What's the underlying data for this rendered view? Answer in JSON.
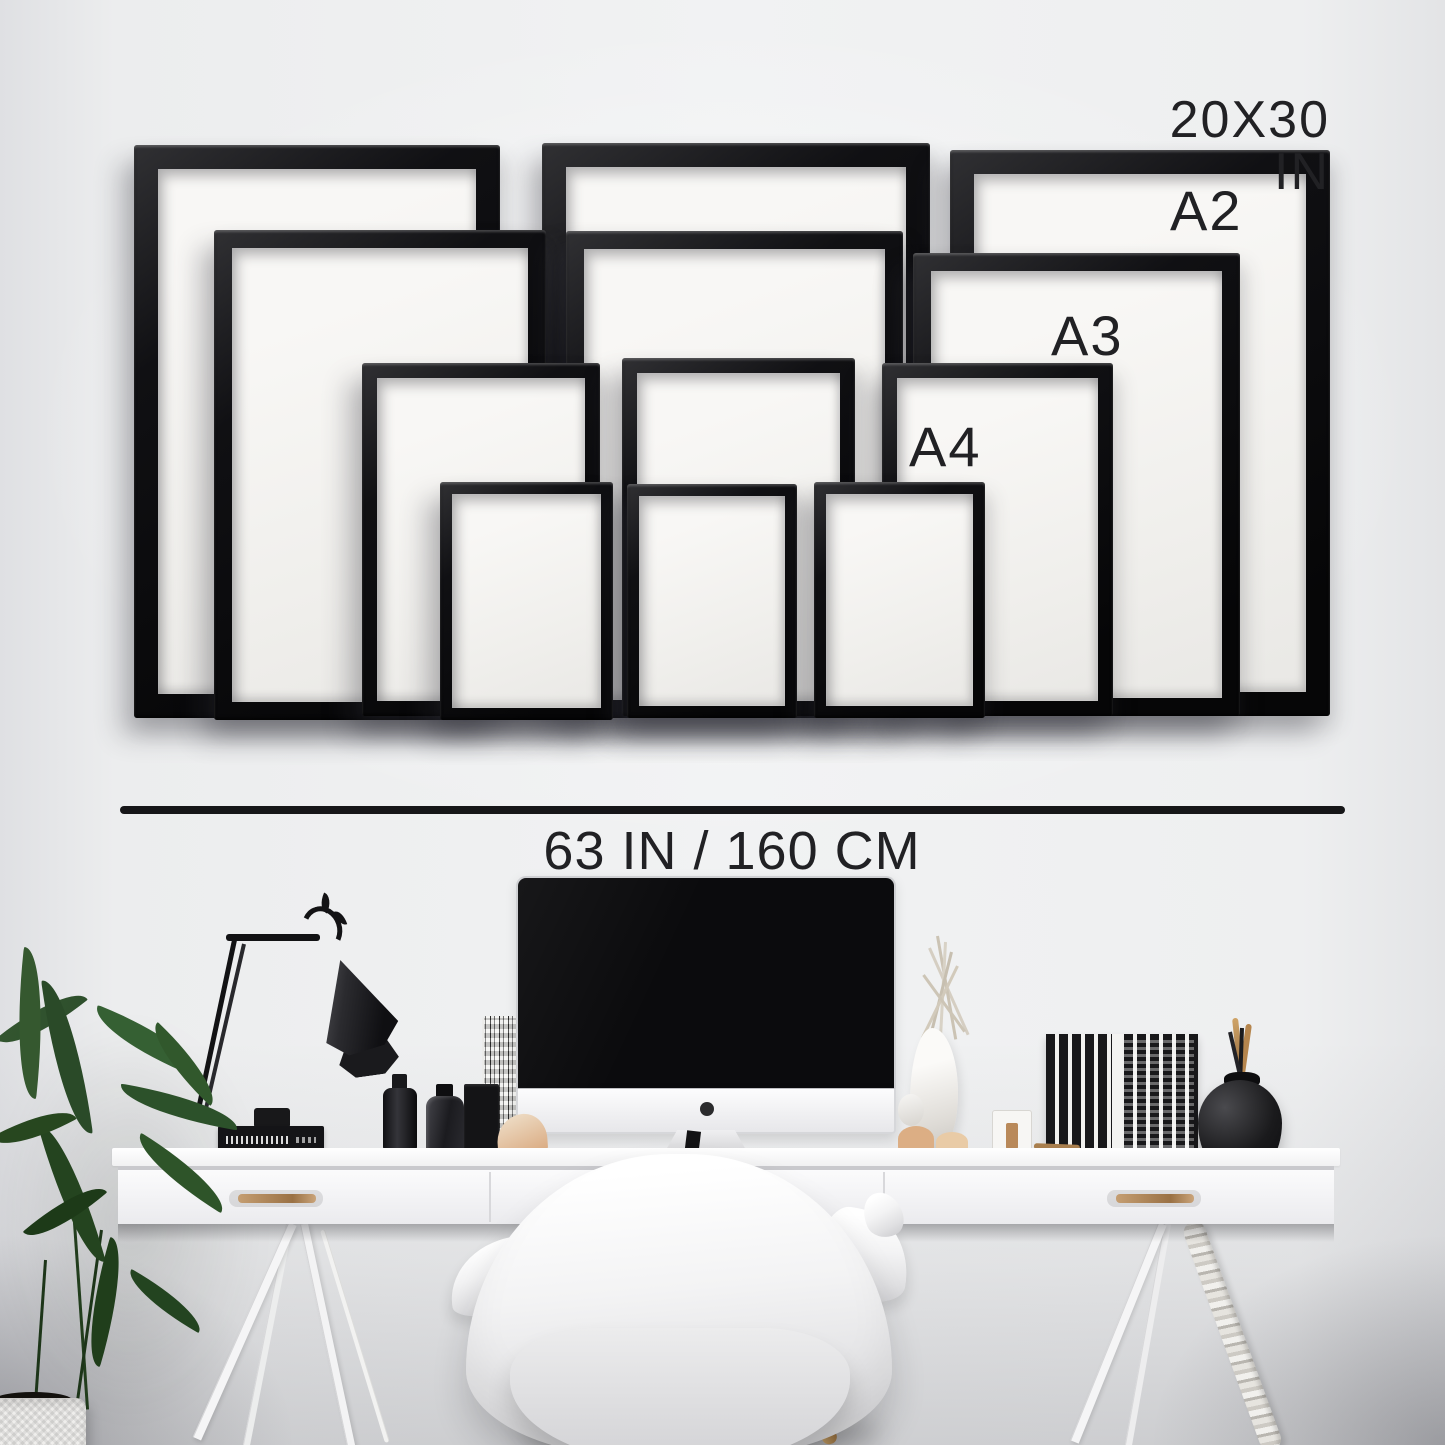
{
  "size_chart": {
    "sizes": [
      {
        "id": "20x30in",
        "label": "20X30 IN",
        "frames_shown": 3
      },
      {
        "id": "a2",
        "label": "A2",
        "frames_shown": 3
      },
      {
        "id": "a3",
        "label": "A3",
        "frames_shown": 3
      },
      {
        "id": "a4",
        "label": "A4",
        "frames_shown": 3
      }
    ],
    "wall_width_label": "63 IN / 160 CM"
  },
  "palette": {
    "frame_black": "#0d0d0f",
    "paper_white": "#f4f3f1",
    "wall_light": "#eff0f1",
    "text": "#212124",
    "brass_handle": "#b08a58",
    "plant_green": "#2c512a",
    "wood_leg": "#b08a52"
  },
  "scene_objects": [
    "picture-frames-wall-gallery",
    "measure-line",
    "imac-computer",
    "desk-lamp",
    "white-desk-with-drawers",
    "brass-drawer-handles",
    "eames-style-chair",
    "potted-green-plant",
    "white-vase-dried-branches",
    "black-books-row",
    "round-black-vase-with-brushes",
    "trestle-legs",
    "braided-cable",
    "black-bottles",
    "speckled-glass",
    "white-ribbed-pot"
  ]
}
